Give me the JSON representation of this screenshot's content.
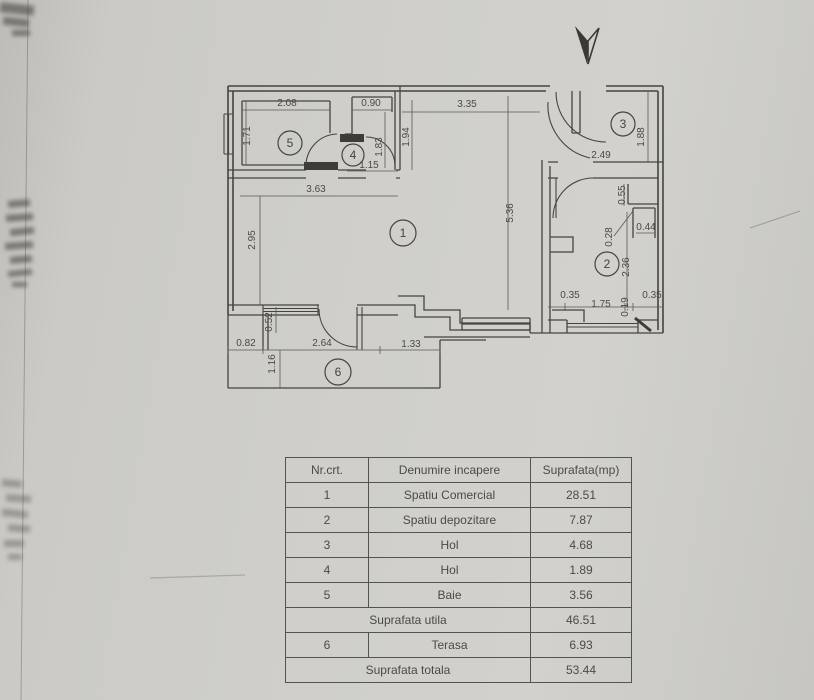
{
  "document": {
    "type_label": "scanned floor plan with area table",
    "paper_color": "#d0cfca",
    "line_color": "#454440",
    "text_color": "#4b4a45"
  },
  "plan": {
    "north_arrow": "north-arrow",
    "room_badges": [
      {
        "n": "1",
        "x": 403,
        "y": 233,
        "r": 13
      },
      {
        "n": "2",
        "x": 607,
        "y": 264,
        "r": 12
      },
      {
        "n": "3",
        "x": 623,
        "y": 124,
        "r": 12
      },
      {
        "n": "4",
        "x": 353,
        "y": 155,
        "r": 11
      },
      {
        "n": "5",
        "x": 290,
        "y": 143,
        "r": 12
      },
      {
        "n": "6",
        "x": 338,
        "y": 372,
        "r": 13
      }
    ],
    "dims_h": [
      {
        "t": "2.08",
        "x": 287,
        "y": 106
      },
      {
        "t": "0.90",
        "x": 371,
        "y": 106
      },
      {
        "t": "3.35",
        "x": 467,
        "y": 107
      },
      {
        "t": "1.15",
        "x": 369,
        "y": 168
      },
      {
        "t": "3.63",
        "x": 316,
        "y": 192
      },
      {
        "t": "2.49",
        "x": 601,
        "y": 158
      },
      {
        "t": "0.44",
        "x": 646,
        "y": 230
      },
      {
        "t": "0.35",
        "x": 570,
        "y": 298
      },
      {
        "t": "1.75",
        "x": 601,
        "y": 307
      },
      {
        "t": "0.35",
        "x": 652,
        "y": 298
      },
      {
        "t": "0.82",
        "x": 246,
        "y": 346
      },
      {
        "t": "2.64",
        "x": 322,
        "y": 346
      },
      {
        "t": "1.33",
        "x": 411,
        "y": 347
      }
    ],
    "dims_v": [
      {
        "t": "1.71",
        "x": 250,
        "y": 136
      },
      {
        "t": "1.83",
        "x": 382,
        "y": 147
      },
      {
        "t": "1.94",
        "x": 409,
        "y": 137
      },
      {
        "t": "5.36",
        "x": 513,
        "y": 213
      },
      {
        "t": "2.95",
        "x": 255,
        "y": 240
      },
      {
        "t": "1.88",
        "x": 644,
        "y": 137
      },
      {
        "t": "0.55",
        "x": 625,
        "y": 195
      },
      {
        "t": "0.28",
        "x": 612,
        "y": 237
      },
      {
        "t": "2.36",
        "x": 629,
        "y": 267
      },
      {
        "t": "0.19",
        "x": 628,
        "y": 307
      },
      {
        "t": "0.52",
        "x": 272,
        "y": 322
      },
      {
        "t": "1.16",
        "x": 275,
        "y": 364
      }
    ]
  },
  "table": {
    "headers": [
      "Nr.crt.",
      "Denumire incapere",
      "Suprafata(mp)"
    ],
    "rows": [
      {
        "nr": "1",
        "name": "Spatiu Comercial",
        "area": "28.51"
      },
      {
        "nr": "2",
        "name": "Spatiu depozitare",
        "area": "7.87"
      },
      {
        "nr": "3",
        "name": "Hol",
        "area": "4.68"
      },
      {
        "nr": "4",
        "name": "Hol",
        "area": "1.89"
      },
      {
        "nr": "5",
        "name": "Baie",
        "area": "3.56"
      },
      {
        "merged": "Suprafata utila",
        "area": "46.51"
      },
      {
        "nr": "6",
        "name": "Terasa",
        "area": "6.93"
      },
      {
        "merged": "Suprafata totala",
        "area": "53.44"
      }
    ]
  }
}
